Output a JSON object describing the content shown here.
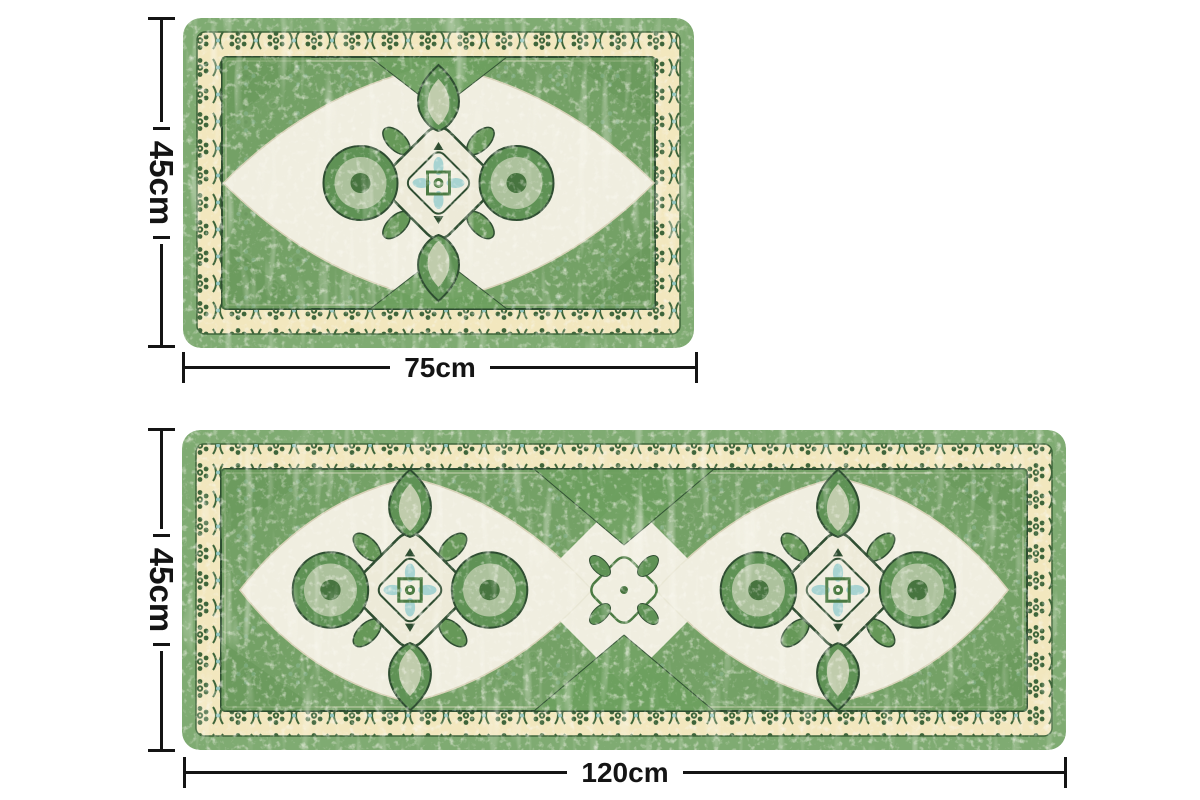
{
  "diagram": {
    "top_rug": {
      "height_label": "45cm",
      "width_label": "75cm"
    },
    "bottom_rug": {
      "height_label": "45cm",
      "width_label": "120cm"
    }
  },
  "colors": {
    "background": "#ffffff",
    "dimension_line": "#141414",
    "rug_edge_green": "#7fab72",
    "rug_field_green": "#74a166",
    "border_band_gold": "#f2e7be",
    "motif_dark_green": "#3e653a",
    "outline_dark_green": "#2e4d31",
    "cream_field": "#f0eee0",
    "accent_blue": "#a7d3d1"
  }
}
